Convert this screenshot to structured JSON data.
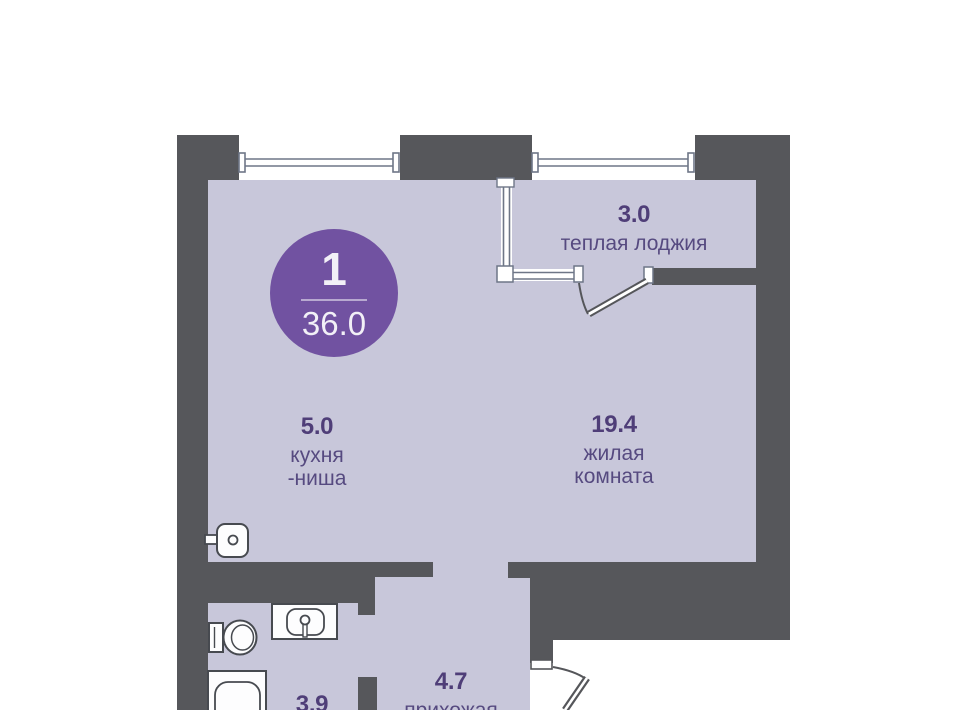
{
  "plan_badge": {
    "rooms_count": "1",
    "total_area": "36.0"
  },
  "rooms": [
    {
      "id": "loggia",
      "area": "3.0",
      "line1": "теплая лоджия"
    },
    {
      "id": "kitchen",
      "area": "5.0",
      "line1": "кухня",
      "line2": "-ниша"
    },
    {
      "id": "living",
      "area": "19.4",
      "line1": "жилая",
      "line2": "комната"
    },
    {
      "id": "hallway",
      "area": "4.7",
      "line1": "прихожая"
    },
    {
      "id": "bathroom",
      "area": "3.9"
    }
  ],
  "fixtures": [
    "kitchen-sink",
    "toilet",
    "bathroom-sink",
    "bathtub"
  ],
  "architecture": [
    "window",
    "window",
    "loggia-glazing",
    "loggia-door",
    "entrance-door"
  ],
  "colors": {
    "wall": "#56575b",
    "room_fill": "#c8c7da",
    "badge_bg": "#7152a1",
    "area_number_text": "#4f3e78",
    "room_name_text": "#564a80",
    "fixture_outline": "#474a50",
    "glazing_line": "#6e7687",
    "background": "#ffffff"
  }
}
